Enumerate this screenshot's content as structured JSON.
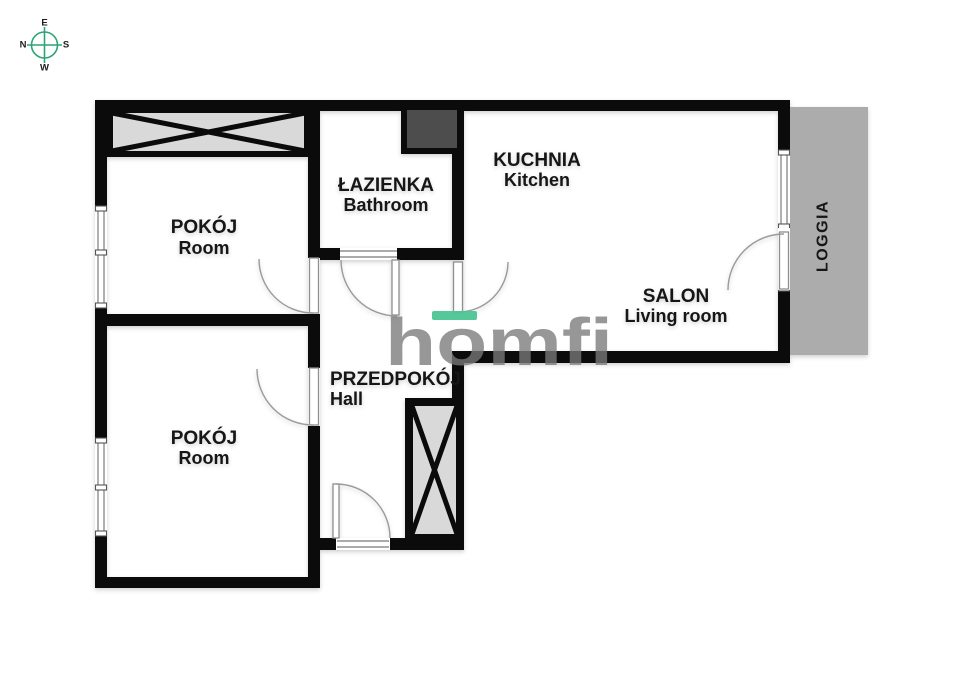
{
  "compass": {
    "top": "E",
    "right": "S",
    "bottom": "W",
    "left": "N"
  },
  "watermark": {
    "text": "homfi"
  },
  "rooms": [
    {
      "name": "POKÓJ",
      "translation": "Room"
    },
    {
      "name": "ŁAZIENKA",
      "translation": "Bathroom"
    },
    {
      "name": "KUCHNIA",
      "translation": "Kitchen"
    },
    {
      "name": "SALON",
      "translation": "Living room"
    },
    {
      "name": "PRZEDPOKÓJ",
      "translation": "Hall"
    },
    {
      "name": "POKÓJ",
      "translation": "Room"
    },
    {
      "name": "LOGGIA",
      "translation": ""
    }
  ],
  "colors": {
    "wall": "#0b0b0b",
    "loggia_fill": "#acacac",
    "wardrobe_fill": "#d9d9d9",
    "duct_fill": "#4d4d4d",
    "brand_green": "#4cc595",
    "compass_green": "#2ba477",
    "watermark_gray": "#7a7a7a"
  }
}
